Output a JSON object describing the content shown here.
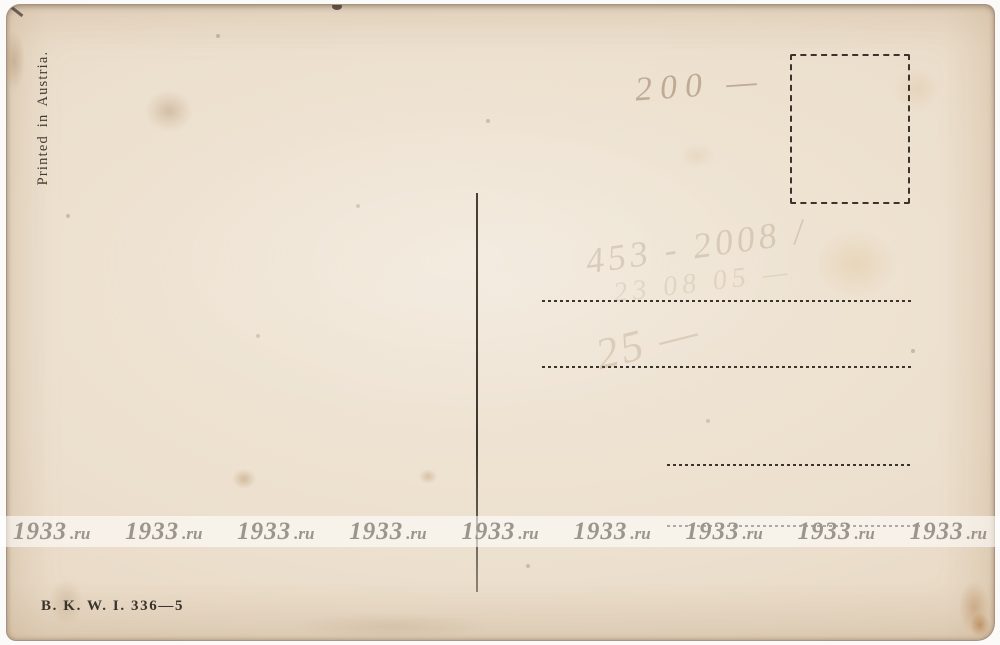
{
  "card": {
    "printed_in": "Printed in Austria.",
    "publisher_code": "B. K. W. I. 336—5",
    "handwriting": {
      "price": "200 —",
      "note1": "453 - 2008 /",
      "note2": "23 08 05 —",
      "note3": "25 —"
    }
  },
  "watermark": {
    "digits": "1933",
    "suffix": ".ru",
    "repeat_count": 9
  },
  "colors": {
    "paper": "#ecdfcd",
    "ink": "#3a342c",
    "pencil": "#96785c",
    "watermark_text": "#9b958c",
    "watermark_band": "rgba(255,255,255,0.58)",
    "background": "#fbfaf8"
  }
}
